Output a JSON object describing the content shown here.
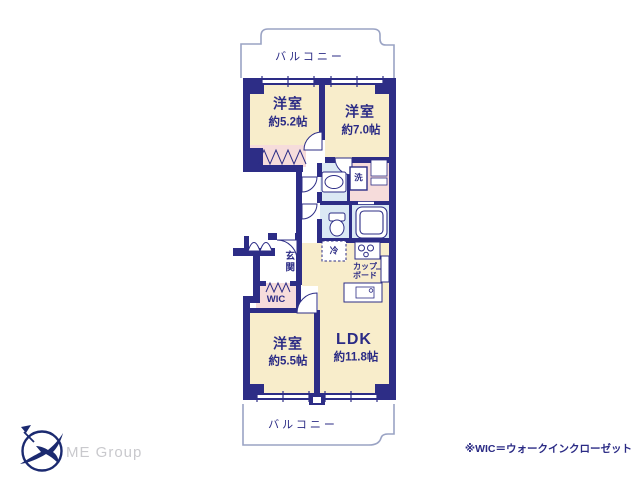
{
  "plan": {
    "balcony_top": "バルコニー",
    "balcony_bottom": "バルコニー",
    "room52_name": "洋室",
    "room52_size": "約5.2帖",
    "room70_name": "洋室",
    "room70_size": "約7.0帖",
    "room55_name": "洋室",
    "room55_size": "約5.5帖",
    "ldk_name": "LDK",
    "ldk_size": "約11.8帖",
    "genkan": "玄関",
    "wic": "WIC",
    "laundry": "洗",
    "fridge": "冷",
    "cupboard_line1": "カップ",
    "cupboard_line2": "ボード"
  },
  "footer": {
    "note": "※WIC＝ウォークインクローゼット",
    "logo_text": "ME Group"
  },
  "icons": {
    "logo_mark": "bird-in-circle-logo-icon",
    "fixtures": [
      "washbasin-icon",
      "toilet-icon",
      "bathtub-icon",
      "stove-icon",
      "kitchen-sink-icon"
    ]
  },
  "colors": {
    "wall": "#2d2d86",
    "room_fill": "#f8edcb",
    "closet_fill": "#f6dcdb",
    "wet_area_fill": "#dbe9f4",
    "balcony_rail": "#9aa3c4",
    "text": "#2b2b85",
    "logo": "#1b2a70",
    "logo_text_gray": "#c9c9cd"
  }
}
